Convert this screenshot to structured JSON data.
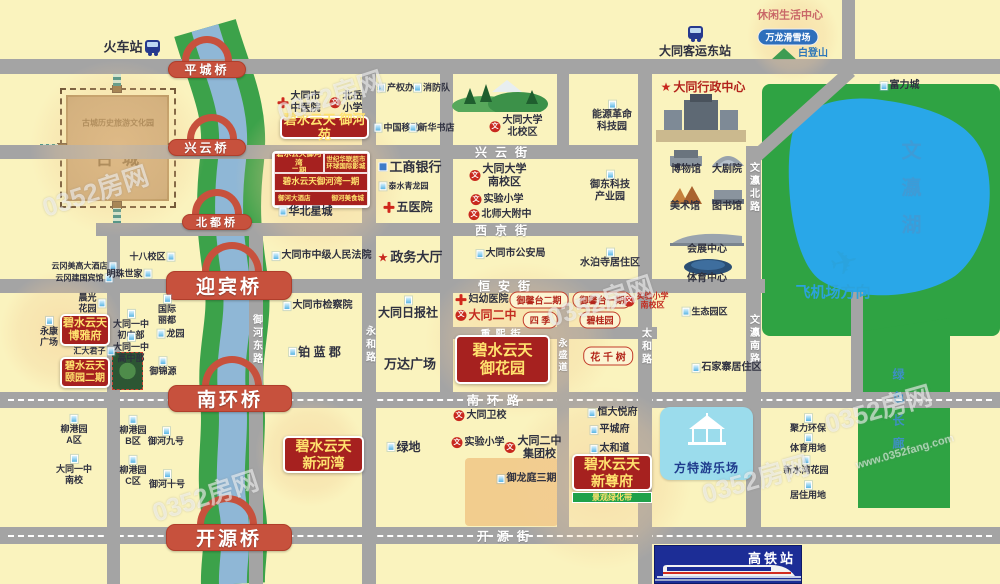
{
  "watermark": {
    "brand": "0352房网",
    "url": "www.0352fang.com"
  },
  "icons": {
    "school_glyph": "文",
    "star_glyph": "★",
    "plane_glyph": "✈"
  },
  "areas": {
    "ancient_city_sub": "古城历史旅游文化园",
    "ancient_city": "古城",
    "lake": "文瀛湖",
    "green_corridor": "绿色长廊"
  },
  "special": {
    "fantawild": "方特游乐场",
    "hsr_station": "高铁站"
  },
  "riverbay": {
    "phase2": "碧水云天御河湾\n二期",
    "mall": "世纪华联超市\n环球国际影城",
    "phase1": "碧水云天御河湾一期",
    "hotel": "御河大酒店",
    "food": "御河美食城"
  },
  "properties": [
    {
      "name": "碧水云天 御河苑",
      "x": 280,
      "y": 116,
      "w": 89,
      "h": 23,
      "fs": 13
    },
    {
      "name": "碧水云天\n博雅府",
      "x": 60,
      "y": 314,
      "w": 50,
      "h": 32,
      "fs": 11
    },
    {
      "name": "碧水云天\n颐园二期",
      "x": 60,
      "y": 357,
      "w": 50,
      "h": 31,
      "fs": 10
    },
    {
      "name": "碧水云天\n御花园",
      "x": 455,
      "y": 335,
      "w": 95,
      "h": 49,
      "fs": 15
    },
    {
      "name": "碧水云天\n新河湾",
      "x": 283,
      "y": 436,
      "w": 81,
      "h": 37,
      "fs": 14
    },
    {
      "name": "碧水云天\n新尊府",
      "x": 572,
      "y": 454,
      "w": 80,
      "h": 37,
      "fs": 14,
      "strip": "景观绿化带"
    }
  ],
  "bridges": [
    {
      "label": "平城桥",
      "x": 168,
      "y": 61,
      "w": 78,
      "h": 17,
      "fs": 12,
      "ax": 182,
      "ay": 36,
      "aw": 50,
      "ah": 25
    },
    {
      "label": "兴云桥",
      "x": 168,
      "y": 139,
      "w": 78,
      "h": 17,
      "fs": 12,
      "ax": 187,
      "ay": 114,
      "aw": 50,
      "ah": 25
    },
    {
      "label": "北都桥",
      "x": 182,
      "y": 214,
      "w": 70,
      "h": 16,
      "fs": 11,
      "ax": 192,
      "ay": 189,
      "aw": 50,
      "ah": 25
    },
    {
      "label": "迎宾桥",
      "x": 166,
      "y": 271,
      "w": 126,
      "h": 29,
      "fs": 19,
      "ax": 202,
      "ay": 242,
      "aw": 60,
      "ah": 30
    },
    {
      "label": "南环桥",
      "x": 168,
      "y": 385,
      "w": 124,
      "h": 27,
      "fs": 19,
      "ax": 202,
      "ay": 356,
      "aw": 60,
      "ah": 30
    },
    {
      "label": "开源桥",
      "x": 166,
      "y": 524,
      "w": 126,
      "h": 27,
      "fs": 19,
      "ax": 197,
      "ay": 495,
      "aw": 60,
      "ah": 30
    }
  ],
  "roads": {
    "h": [
      {
        "x": 0,
        "y": 59,
        "w": 1000,
        "h": 15
      },
      {
        "x": 0,
        "y": 145,
        "w": 642,
        "h": 14
      },
      {
        "x": 96,
        "y": 223,
        "w": 546,
        "h": 13
      },
      {
        "x": 0,
        "y": 279,
        "w": 765,
        "h": 14
      },
      {
        "x": 443,
        "y": 327,
        "w": 214,
        "h": 12
      },
      {
        "x": 0,
        "y": 392,
        "w": 1000,
        "h": 16,
        "dashed": true
      },
      {
        "x": 0,
        "y": 527,
        "w": 1000,
        "h": 17,
        "dashed": true
      }
    ],
    "v": [
      {
        "x": 107,
        "y": 223,
        "w": 13,
        "h": 361
      },
      {
        "x": 362,
        "y": 59,
        "w": 14,
        "h": 525
      },
      {
        "x": 440,
        "y": 59,
        "w": 13,
        "h": 333
      },
      {
        "x": 557,
        "y": 59,
        "w": 12,
        "h": 88
      },
      {
        "x": 557,
        "y": 279,
        "w": 12,
        "h": 248
      },
      {
        "x": 638,
        "y": 59,
        "w": 14,
        "h": 525
      },
      {
        "x": 746,
        "y": 146,
        "w": 15,
        "h": 381
      },
      {
        "x": 249,
        "y": 223,
        "w": 14,
        "h": 361
      },
      {
        "x": 842,
        "y": 0,
        "w": 13,
        "h": 60
      },
      {
        "x": 851,
        "y": 292,
        "w": 12,
        "h": 100
      }
    ],
    "diag": [
      {
        "x": 757,
        "y": 149,
        "len": 126,
        "angle": -42,
        "h": 13
      }
    ]
  },
  "road_labels": [
    {
      "text": "兴云街",
      "x": 505,
      "y": 152
    },
    {
      "text": "西京街",
      "x": 505,
      "y": 230
    },
    {
      "text": "恒安街",
      "x": 508,
      "y": 286
    },
    {
      "text": "重熙街",
      "x": 503,
      "y": 333,
      "fs": 10,
      "ls": 5
    },
    {
      "text": "南环路",
      "x": 497,
      "y": 400
    },
    {
      "text": "开源街",
      "x": 507,
      "y": 536
    },
    {
      "text": "永和路",
      "x": 369,
      "y": 345,
      "vert": true
    },
    {
      "text": "永盛道",
      "x": 563,
      "y": 356,
      "vert": true,
      "fs": 9
    },
    {
      "text": "太和路",
      "x": 645,
      "y": 347,
      "vert": true
    },
    {
      "text": "文瀛北路",
      "x": 753,
      "y": 188,
      "vert": true
    },
    {
      "text": "文瀛南路",
      "x": 753,
      "y": 340,
      "vert": true
    },
    {
      "text": "御河东路",
      "x": 256,
      "y": 340,
      "vert": true
    }
  ],
  "places": [
    {
      "t": "火车站",
      "x": 123,
      "y": 47,
      "ty": "p",
      "fs": 13,
      "bold": 1
    },
    {
      "t": "大同客运东站",
      "x": 695,
      "y": 51,
      "ty": "p",
      "fs": 12,
      "bold": 1
    },
    {
      "t": "休闲生活中心",
      "x": 790,
      "y": 16,
      "ty": "p",
      "c": "#C96868",
      "fs": 11,
      "bold": 1
    },
    {
      "t": "万龙滑雪场",
      "x": 788,
      "y": 37,
      "ty": "bpill"
    },
    {
      "t": "白登山",
      "x": 800,
      "y": 54,
      "ty": "m",
      "c": "#2E77B8",
      "bold": 1
    },
    {
      "t": "富力城",
      "x": 900,
      "y": 86,
      "ty": "b",
      "bold": 1
    },
    {
      "t": "大同市\n中医院",
      "x": 299,
      "y": 103,
      "ty": "h",
      "bold": 1
    },
    {
      "t": "北岳\n小学",
      "x": 346,
      "y": 103,
      "ty": "s",
      "bold": 1
    },
    {
      "t": "产权办",
      "x": 396,
      "y": 88,
      "ty": "b",
      "fs": 9
    },
    {
      "t": "消防队",
      "x": 432,
      "y": 88,
      "ty": "b",
      "fs": 9
    },
    {
      "t": "中国移动",
      "x": 397,
      "y": 128,
      "ty": "b",
      "fs": 9
    },
    {
      "t": "新华书店",
      "x": 432,
      "y": 128,
      "ty": "b",
      "fs": 9
    },
    {
      "t": "大同大学\n北校区",
      "x": 516,
      "y": 127,
      "ty": "s",
      "bold": 1
    },
    {
      "t": "能源革命\n科技园",
      "x": 612,
      "y": 117,
      "ty": "b",
      "ip": "t"
    },
    {
      "t": "大同行政中心",
      "x": 703,
      "y": 87,
      "ty": "st",
      "c": "#B3231C",
      "fs": 12,
      "bold": 1
    },
    {
      "t": "工商银行",
      "x": 410,
      "y": 167,
      "ty": "k",
      "fs": 13,
      "bold": 1
    },
    {
      "t": "泰水青龙园",
      "x": 404,
      "y": 186,
      "ty": "b",
      "fs": 8
    },
    {
      "t": "五医院",
      "x": 408,
      "y": 207,
      "ty": "h",
      "fs": 12,
      "bold": 1
    },
    {
      "t": "大同大学\n南校区",
      "x": 498,
      "y": 176,
      "ty": "s",
      "fs": 11,
      "bold": 1
    },
    {
      "t": "实验小学",
      "x": 497,
      "y": 200,
      "ty": "s"
    },
    {
      "t": "北师大附中",
      "x": 500,
      "y": 215,
      "ty": "s"
    },
    {
      "t": "御东科技\n产业园",
      "x": 610,
      "y": 187,
      "ty": "b",
      "ip": "t"
    },
    {
      "t": "博物馆",
      "x": 686,
      "y": 170,
      "ty": "p",
      "bold": 1
    },
    {
      "t": "大剧院",
      "x": 727,
      "y": 170,
      "ty": "p",
      "bold": 1
    },
    {
      "t": "美术馆",
      "x": 685,
      "y": 207,
      "ty": "p",
      "bold": 1
    },
    {
      "t": "图书馆",
      "x": 727,
      "y": 207,
      "ty": "p",
      "bold": 1
    },
    {
      "t": "会展中心",
      "x": 707,
      "y": 250,
      "ty": "p",
      "bold": 1
    },
    {
      "t": "体育中心",
      "x": 707,
      "y": 279,
      "ty": "p",
      "bold": 1
    },
    {
      "t": "华北星城",
      "x": 306,
      "y": 212,
      "ty": "b",
      "fs": 11,
      "bold": 1
    },
    {
      "t": "大同市中级人民法院",
      "x": 322,
      "y": 256,
      "ty": "b"
    },
    {
      "t": "政务大厅",
      "x": 410,
      "y": 257,
      "ty": "st",
      "fs": 13,
      "bold": 1
    },
    {
      "t": "大同市公安局",
      "x": 511,
      "y": 254,
      "ty": "b"
    },
    {
      "t": "水泊寺居住区",
      "x": 610,
      "y": 259,
      "ty": "b",
      "ip": "t"
    },
    {
      "t": "十八校区",
      "x": 152,
      "y": 257,
      "ty": "b",
      "ip": "r",
      "fs": 9
    },
    {
      "t": "云冈美高大酒店",
      "x": 84,
      "y": 266,
      "ty": "b",
      "ip": "r",
      "fs": 8
    },
    {
      "t": "云冈建国宾馆",
      "x": 84,
      "y": 278,
      "ty": "b",
      "ip": "r",
      "fs": 8
    },
    {
      "t": "明珠世家",
      "x": 129,
      "y": 274,
      "ty": "b",
      "ip": "r",
      "fs": 9
    },
    {
      "t": "晨光\n花园",
      "x": 92,
      "y": 303,
      "ty": "b",
      "ip": "r",
      "fs": 9
    },
    {
      "t": "永康\n广场",
      "x": 49,
      "y": 332,
      "ty": "b",
      "ip": "t",
      "fs": 9
    },
    {
      "t": "大同一中\n初中部",
      "x": 131,
      "y": 325,
      "ty": "b",
      "ip": "t",
      "fs": 9
    },
    {
      "t": "大同一中\n高中部",
      "x": 131,
      "y": 348,
      "ty": "b",
      "ip": "t",
      "fs": 9
    },
    {
      "t": "国际\n丽都",
      "x": 167,
      "y": 310,
      "ty": "b",
      "ip": "t",
      "fs": 9
    },
    {
      "t": "龙园",
      "x": 171,
      "y": 334,
      "ty": "b",
      "fs": 9
    },
    {
      "t": "汇大君子",
      "x": 94,
      "y": 351,
      "ty": "b",
      "ip": "r",
      "fs": 8
    },
    {
      "t": "御锦源",
      "x": 163,
      "y": 367,
      "ty": "b",
      "ip": "t",
      "fs": 9
    },
    {
      "t": "大同市检察院",
      "x": 318,
      "y": 306,
      "ty": "b"
    },
    {
      "t": "大同日报社",
      "x": 408,
      "y": 308,
      "ty": "b",
      "ip": "t",
      "fs": 12,
      "bold": 1
    },
    {
      "t": "铂 蓝 郡",
      "x": 315,
      "y": 352,
      "ty": "b",
      "fs": 12,
      "bold": 1
    },
    {
      "t": "万达广场",
      "x": 410,
      "y": 364,
      "ty": "r",
      "fs": 13
    },
    {
      "t": "妇幼医院",
      "x": 482,
      "y": 300,
      "ty": "h",
      "bold": 1
    },
    {
      "t": "大同二中",
      "x": 486,
      "y": 315,
      "ty": "s",
      "c": "#C32B20",
      "fs": 12,
      "bold": 1
    },
    {
      "t": "御馨台二期",
      "x": 539,
      "y": 300,
      "ty": "pill"
    },
    {
      "t": "御馨台一期",
      "x": 602,
      "y": 300,
      "ty": "pill"
    },
    {
      "t": "实验小学\n南校区",
      "x": 646,
      "y": 301,
      "ty": "s",
      "c": "#C32B20",
      "fs": 8
    },
    {
      "t": "四 季",
      "x": 540,
      "y": 320,
      "ty": "pill"
    },
    {
      "t": "碧桂园",
      "x": 600,
      "y": 320,
      "ty": "pill"
    },
    {
      "t": "花 千 树",
      "x": 608,
      "y": 356,
      "ty": "pill",
      "fs": 10
    },
    {
      "t": "生态园区",
      "x": 705,
      "y": 312,
      "ty": "b",
      "fs": 9
    },
    {
      "t": "石家寨居住区",
      "x": 727,
      "y": 368,
      "ty": "b"
    },
    {
      "t": "飞机场方向",
      "x": 833,
      "y": 293,
      "ty": "p",
      "c": "#2BA2DC",
      "fs": 15,
      "bold": 1
    },
    {
      "t": "恒大悦府",
      "x": 613,
      "y": 413,
      "ty": "b"
    },
    {
      "t": "平城府",
      "x": 610,
      "y": 430,
      "ty": "b"
    },
    {
      "t": "太和道",
      "x": 610,
      "y": 449,
      "ty": "b"
    },
    {
      "t": "大同卫校",
      "x": 480,
      "y": 416,
      "ty": "s",
      "bold": 1
    },
    {
      "t": "实验小学",
      "x": 478,
      "y": 443,
      "ty": "s",
      "bold": 1
    },
    {
      "t": "大同二中\n集团校",
      "x": 533,
      "y": 448,
      "ty": "s",
      "fs": 11,
      "bold": 1
    },
    {
      "t": "御龙庭三期",
      "x": 527,
      "y": 479,
      "ty": "b",
      "bold": 1
    },
    {
      "t": "绿地",
      "x": 404,
      "y": 447,
      "ty": "b",
      "fs": 12,
      "bold": 1
    },
    {
      "t": "柳港园\nA区",
      "x": 74,
      "y": 430,
      "ty": "b",
      "ip": "t",
      "fs": 9
    },
    {
      "t": "大同一中\n南校",
      "x": 74,
      "y": 470,
      "ty": "b",
      "ip": "t",
      "fs": 9
    },
    {
      "t": "柳港园\nB区",
      "x": 133,
      "y": 431,
      "ty": "b",
      "ip": "t",
      "fs": 9
    },
    {
      "t": "柳港园\nC区",
      "x": 133,
      "y": 471,
      "ty": "b",
      "ip": "t",
      "fs": 9
    },
    {
      "t": "御河九号",
      "x": 166,
      "y": 437,
      "ty": "b",
      "ip": "t",
      "fs": 9
    },
    {
      "t": "御河十号",
      "x": 167,
      "y": 480,
      "ty": "b",
      "ip": "t",
      "fs": 9
    },
    {
      "t": "聚力环保",
      "x": 808,
      "y": 424,
      "ty": "b",
      "ip": "t",
      "fs": 9
    },
    {
      "t": "体育用地",
      "x": 808,
      "y": 444,
      "ty": "b",
      "ip": "t",
      "fs": 9
    },
    {
      "t": "新水湾花园",
      "x": 806,
      "y": 466,
      "ty": "b",
      "ip": "t",
      "fs": 9
    },
    {
      "t": "居住用地",
      "x": 808,
      "y": 491,
      "ty": "b",
      "ip": "t",
      "fs": 9
    }
  ],
  "watermarks": [
    {
      "x": 95,
      "y": 190,
      "r": -18
    },
    {
      "x": 330,
      "y": 95,
      "r": -18
    },
    {
      "x": 205,
      "y": 495,
      "r": -18
    },
    {
      "x": 600,
      "y": 300,
      "r": -18
    },
    {
      "x": 878,
      "y": 408,
      "r": -16
    },
    {
      "x": 755,
      "y": 478,
      "r": -16
    },
    {
      "x": 905,
      "y": 452,
      "r": -16,
      "url": true,
      "fs": 11
    }
  ]
}
